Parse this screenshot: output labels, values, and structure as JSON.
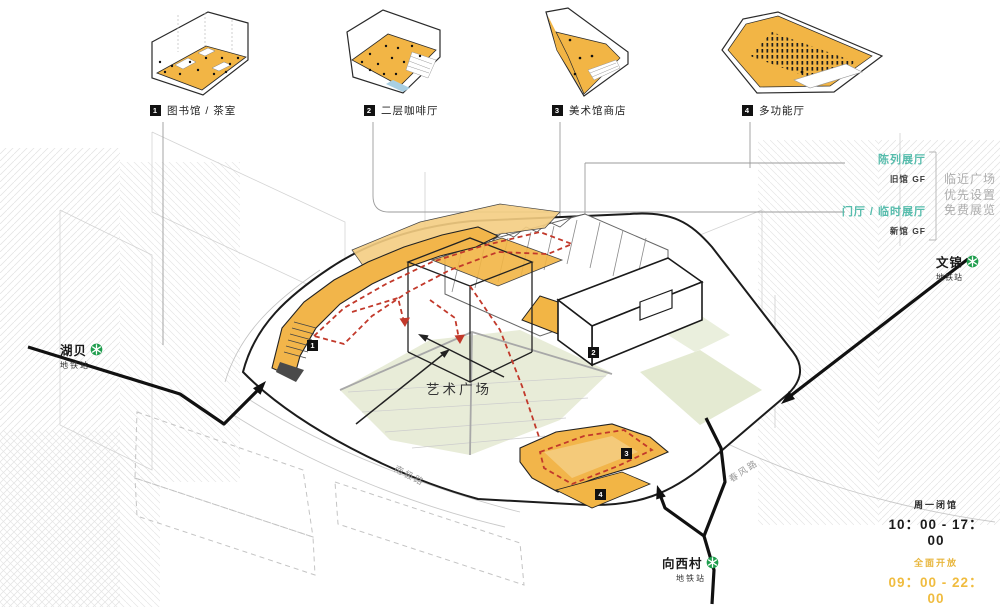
{
  "callouts": [
    {
      "num": "1",
      "label": "图书馆 / 茶室"
    },
    {
      "num": "2",
      "label": "二层咖啡厅"
    },
    {
      "num": "3",
      "label": "美术馆商店"
    },
    {
      "num": "4",
      "label": "多功能厅"
    }
  ],
  "annotations": {
    "exhibit_hall": "陈列展厅",
    "old_gf": "旧馆 GF",
    "foyer_temp": "门厅 / 临时展厅",
    "new_gf": "新馆 GF",
    "notes": [
      "临近广场",
      "优先设置",
      "免费展览"
    ]
  },
  "stations": {
    "hubei": {
      "name": "湖贝",
      "sub": "地铁站"
    },
    "wenjin": {
      "name": "文锦",
      "sub": "地铁站"
    },
    "xiangxicun": {
      "name": "向西村",
      "sub": "地铁站"
    }
  },
  "site": {
    "plaza_label": "艺术广场",
    "road_sw": "南极路",
    "road_se": "春风路"
  },
  "hours": {
    "museum_note": "周一闭馆",
    "museum_time": "10：00 - 17：00",
    "plaza_note": "全面开放",
    "plaza_time": "09：00 - 22：00"
  },
  "markers": {
    "m1": "1",
    "m2": "2",
    "m3": "3",
    "m4": "4"
  },
  "colors": {
    "floor_yellow": "#F2B545",
    "floor_yellow_light": "#F5CE82",
    "plaza_green": "#E8ECD8",
    "teal_text": "#56BCAC",
    "note_gray": "#ADADAD",
    "route_red": "#C2392B",
    "metro_green": "#1F9D4D",
    "hours_yellow": "#F0BC3F"
  }
}
